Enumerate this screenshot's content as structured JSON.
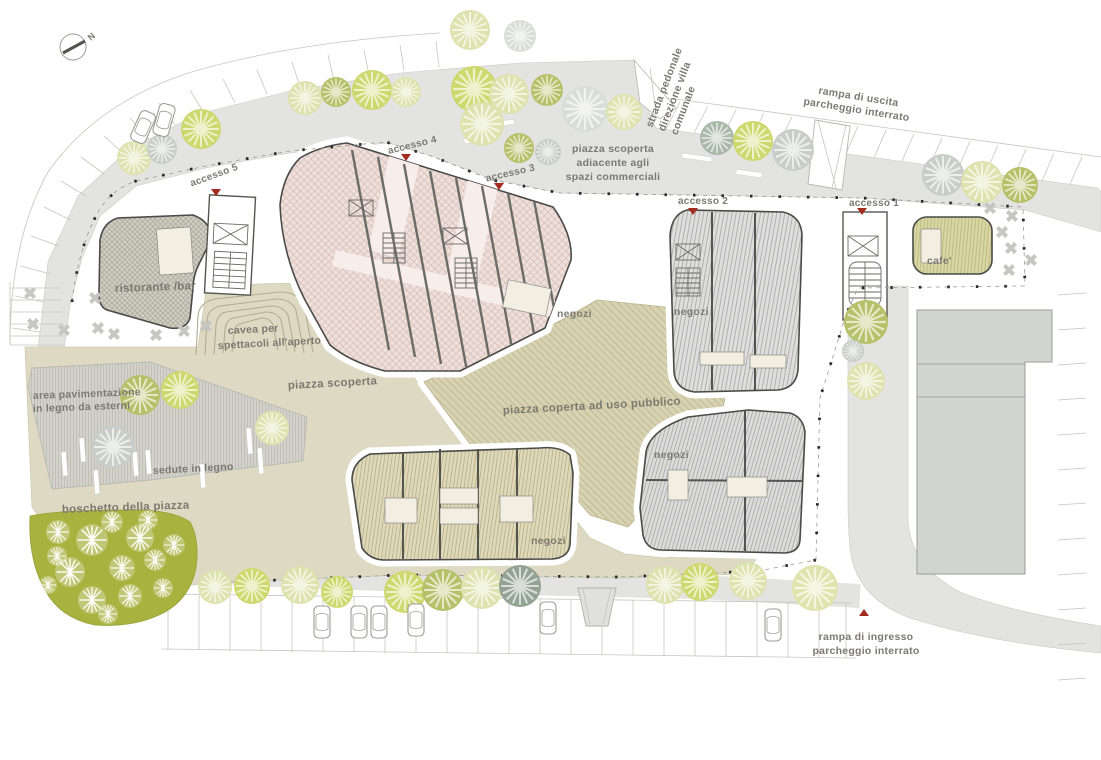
{
  "plan": {
    "north_label": "N",
    "labels": {
      "strada_pedonale_1": "strada pedonale",
      "strada_pedonale_2": "direzione villa",
      "strada_pedonale_3": "comunale",
      "rampa_uscita_1": "rampa di uscita",
      "rampa_uscita_2": "parcheggio interrato",
      "piazza_adiacente_1": "piazza scoperta",
      "piazza_adiacente_2": "adiacente agli",
      "piazza_adiacente_3": "spazi commerciali",
      "accesso_1": "accesso 1",
      "accesso_2": "accesso 2",
      "accesso_3": "accesso 3",
      "accesso_4": "accesso 4",
      "accesso_5": "accesso 5",
      "ristorante": "ristorante /bar",
      "cafe": "cafe'",
      "cavea_1": "cavea per",
      "cavea_2": "spettacoli all'aperto",
      "piazza_scoperta": "piazza scoperta",
      "area_pavimentazione_1": "area pavimentazione",
      "area_pavimentazione_2": "in legno da esterni",
      "sedute": "sedute in legno",
      "boschetto": "boschetto della piazza",
      "negozi": "negozi",
      "piazza_coperta": "piazza coperta ad uso pubblico",
      "rampa_ingresso_1": "rampa di ingresso",
      "rampa_ingresso_2": "parcheggio interrato"
    },
    "colors": {
      "road": "#e3e4e2",
      "piazza_beige": "#ded9c3",
      "piazza_coperta_base": "#d6d2b2",
      "boschetto_green": "#a8b23f",
      "building_outline": "#4a4a48",
      "negozi_pink_base": "#eee0dc",
      "marker_red": "#a32b20",
      "label_gray": "#7b7a71",
      "existing_building": "#d2d4d1"
    }
  }
}
